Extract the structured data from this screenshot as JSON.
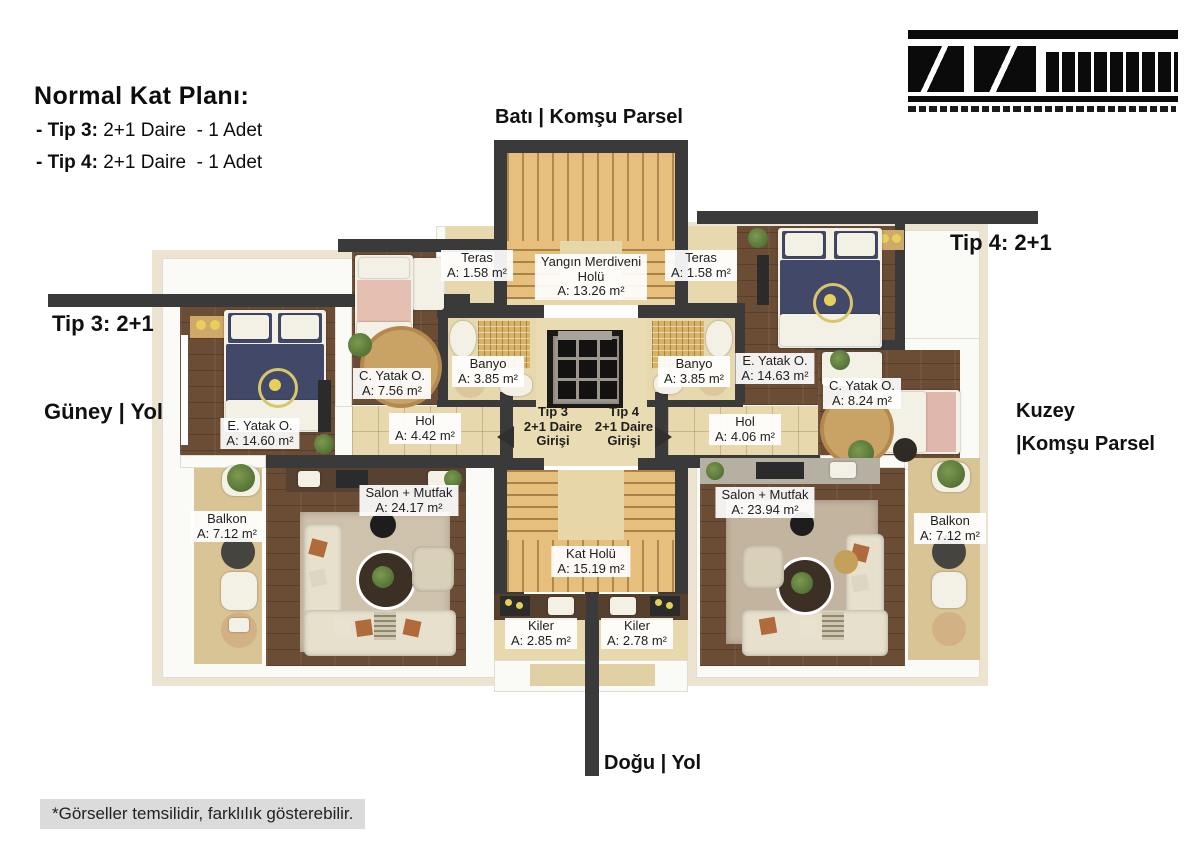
{
  "header": {
    "title": "Normal Kat Planı:",
    "items": [
      {
        "prefix": "- Tip 3:",
        "rest": " 2+1 Daire  - 1 Adet"
      },
      {
        "prefix": "- Tip 4:",
        "rest": " 2+1 Daire  - 1 Adet"
      }
    ]
  },
  "compass": {
    "west": "Batı | Komşu Parsel",
    "east": "Doğu | Yol",
    "south": "Güney | Yol",
    "north_line1": "Kuzey",
    "north_line2": "|Komşu Parsel"
  },
  "unit_markers": {
    "tip3": "Tip 3: 2+1",
    "tip4": "Tip 4: 2+1"
  },
  "entrances": {
    "tip3": {
      "line1": "Tip 3",
      "line2": "2+1 Daire",
      "line3": "Girişi"
    },
    "tip4": {
      "line1": "Tip 4",
      "line2": "2+1 Daire",
      "line3": "Girişi"
    }
  },
  "rooms": {
    "common": {
      "fire_stairs": {
        "name1": "Yangın Merdiveni",
        "name2": "Holü",
        "area": "A: 13.26 m²"
      },
      "kat_holu": {
        "name": "Kat Holü",
        "area": "A: 15.19 m²"
      }
    },
    "tip3": {
      "teras": {
        "name": "Teras",
        "area": "A: 1.58 m²"
      },
      "banyo": {
        "name": "Banyo",
        "area": "A: 3.85 m²"
      },
      "c_yatak": {
        "name": "C. Yatak O.",
        "area": "A: 7.56 m²"
      },
      "e_yatak": {
        "name": "E. Yatak O.",
        "area": "A: 14.60 m²"
      },
      "hol": {
        "name": "Hol",
        "area": "A: 4.42 m²"
      },
      "salon": {
        "name": "Salon + Mutfak",
        "area": "A: 24.17 m²"
      },
      "balkon": {
        "name": "Balkon",
        "area": "A: 7.12 m²"
      },
      "kiler": {
        "name": "Kiler",
        "area": "A: 2.85 m²"
      }
    },
    "tip4": {
      "teras": {
        "name": "Teras",
        "area": "A: 1.58 m²"
      },
      "banyo": {
        "name": "Banyo",
        "area": "A: 3.85 m²"
      },
      "e_yatak": {
        "name": "E. Yatak O.",
        "area": "A: 14.63 m²"
      },
      "c_yatak": {
        "name": "C. Yatak O.",
        "area": "A: 8.24 m²"
      },
      "hol": {
        "name": "Hol",
        "area": "A: 4.06 m²"
      },
      "salon": {
        "name": "Salon + Mutfak",
        "area": "A: 23.94 m²"
      },
      "balkon": {
        "name": "Balkon",
        "area": "A: 7.12 m²"
      },
      "kiler": {
        "name": "Kiler",
        "area": "A: 2.78 m²"
      }
    }
  },
  "footer": {
    "disclaimer": "*Görseller temsilidir, farklılık gösterebilir."
  },
  "palette": {
    "wall": "#3a3a3a",
    "stair_wood": "#e6bf7d",
    "dark_wood": "#6b4c34",
    "tile": "#e7d8ad",
    "bed_navy": "#424968",
    "label_bg": "#ffffff"
  }
}
